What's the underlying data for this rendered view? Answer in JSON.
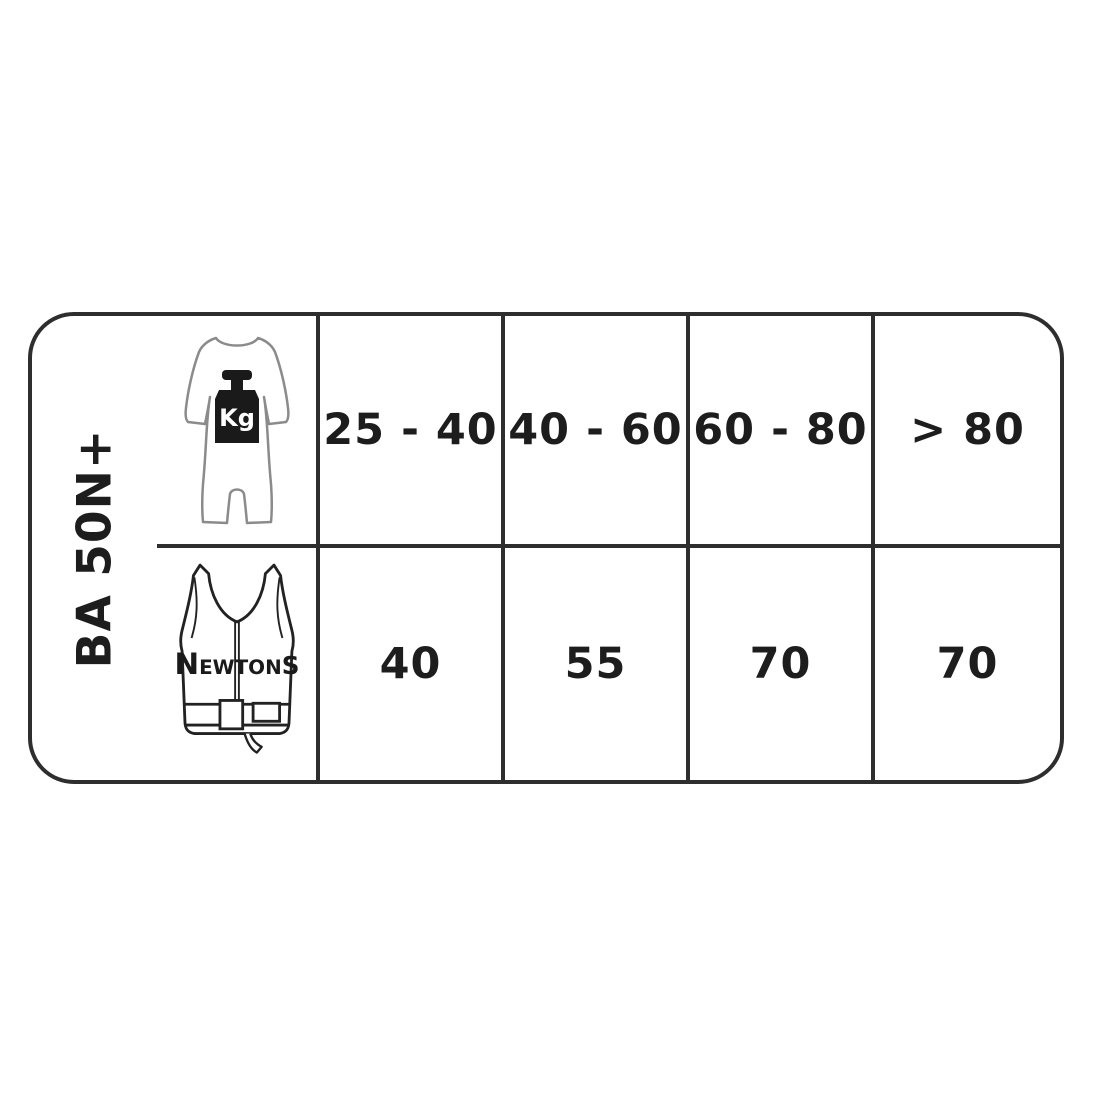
{
  "table": {
    "row_label": "BA 50N+",
    "weight_row": {
      "icon": "person-weight-kg-icon",
      "unit_label": "Kg",
      "cells": [
        "25 - 40",
        "40 - 60",
        "60 - 80",
        "> 80"
      ]
    },
    "buoyancy_row": {
      "icon": "buoyancy-vest-icon",
      "unit_label": "Newtons",
      "unit_label_parts": {
        "first": "N",
        "mid": "EWTON",
        "last": "S"
      },
      "cells": [
        "40",
        "55",
        "70",
        "70"
      ]
    }
  },
  "chart_data": {
    "type": "table",
    "title": "BA 50N+",
    "row_header": "BA 50N+",
    "rows": [
      {
        "label": "Body weight (Kg)",
        "values": [
          "25 - 40",
          "40 - 60",
          "60 - 80",
          "> 80"
        ]
      },
      {
        "label": "Buoyancy (Newtons)",
        "values": [
          40,
          55,
          70,
          70
        ]
      }
    ]
  },
  "colors": {
    "background": "#ffffff",
    "border": "#2e2e2e",
    "text": "#1d1d1d",
    "body_outline": "#8b8b8b",
    "icon_fill": "#1a1a1a"
  }
}
